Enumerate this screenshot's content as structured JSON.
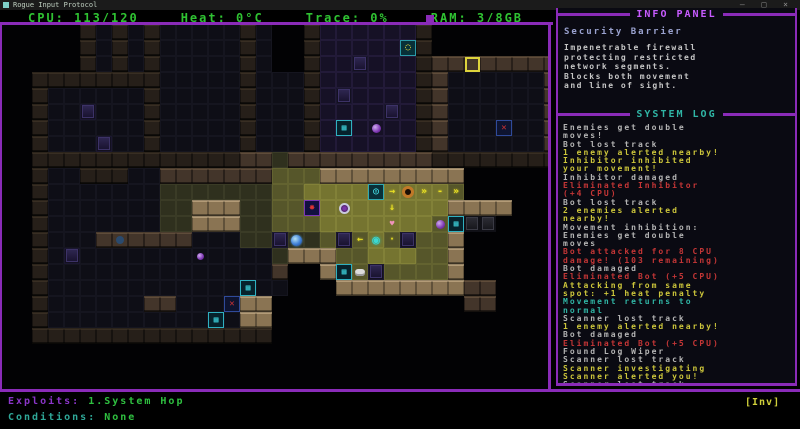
{
  "window": {
    "title": "Rogue Input Protocol",
    "controls": "– □ ×"
  },
  "colors": {
    "accent_purple": "#8a2bb8",
    "text_green": "#2fc232",
    "log_gray": "#b4b4b4",
    "log_yellow": "#cdc63b",
    "log_red": "#c53636",
    "log_cyan": "#30b5a5"
  },
  "stats": [
    {
      "label": "CPU:",
      "value": "113/120"
    },
    {
      "label": "Heat:",
      "value": "0°C"
    },
    {
      "label": "Trace:",
      "value": "0%"
    },
    {
      "label": "RAM:",
      "value": "3/8GB"
    }
  ],
  "map": {
    "tile_size": 16,
    "legend": {
      "#": "w-dark",
      "M": "w-mid",
      "W": "w-lit",
      ".": "f-dark",
      "p": "f-purple",
      "g": "f-dim",
      "y": "f-lit",
      "Y": "f-bright",
      "r": "rack",
      "G": "rack-gray"
    },
    "rows": [
      "     #.#.#.....#.  #pppppp#        ",
      "     #.#.#.....#.  #pppppp#        ",
      "     #.#.#.....#.  #pprppp#MMMMMMMM",
      "  ########.....#...#pppppp#M......M",
      "  #......#.....#...#prpppp#M......M",
      "  #..r...#.....#...#pppprp#M......M",
      "  #......#.....#...#pppppp#M......M",
      "  #...r..#.....#...#pppppp#M......M",
      "  #############MMgMMMMMMMMM########",
      "  #..###..MMMMMMMyyyWWWWWWWWW      ",
      "  #.......gggggggyyYYYYYYYYYy      ",
      "  #.......ggWWWggyyyYYYYYYYYWWWW   ",
      "  #.......ggWWWggyyyYYYYYYYyyGG    ",
      "  #...MMMMMM...ggrggyryYyryyW      ",
      "  #.r............gWWWyyYYYyyW      ",
      "  #..............M  WyyryyyyW      ",
      "  #...............   WWWWWWWWMM    ",
      "  #......MM....WW            MM    ",
      "  #............WW                  ",
      "  ###############                  ",
      "                                   ",
      "                                   ",
      "                                   "
    ],
    "entities": [
      {
        "name": "terminal-node",
        "col": 25,
        "row": 1,
        "cls": "ytc",
        "glyph": "◌"
      },
      {
        "name": "target-cursor",
        "col": 29,
        "row": 2,
        "cls": "cursor",
        "glyph": ""
      },
      {
        "name": "hazard-marker",
        "col": 31,
        "row": 6,
        "cls": "redx",
        "glyph": "✕"
      },
      {
        "name": "data-cache",
        "col": 21,
        "row": 6,
        "cls": "box",
        "glyph": "▦"
      },
      {
        "name": "signal-orb",
        "col": 23,
        "row": 6,
        "cls": "orb-purple",
        "glyph": ""
      },
      {
        "name": "scanner-bot",
        "col": 23,
        "row": 10,
        "cls": "scanner",
        "glyph": "◎"
      },
      {
        "name": "beam-segment",
        "col": 24,
        "row": 10,
        "cls": "beam",
        "glyph": "→"
      },
      {
        "name": "patrol-bot",
        "col": 25,
        "row": 10,
        "cls": "orange",
        "glyph": ""
      },
      {
        "name": "beam-segment",
        "col": 26,
        "row": 10,
        "cls": "beam",
        "glyph": "»"
      },
      {
        "name": "beam-segment",
        "col": 27,
        "row": 10,
        "cls": "beam",
        "glyph": "-"
      },
      {
        "name": "beam-segment",
        "col": 28,
        "row": 10,
        "cls": "beam",
        "glyph": "»"
      },
      {
        "name": "alert-marker",
        "col": 19,
        "row": 11,
        "cls": "star",
        "glyph": "✸"
      },
      {
        "name": "watcher-bot",
        "col": 21,
        "row": 11,
        "cls": "eye",
        "glyph": ""
      },
      {
        "name": "beam-segment",
        "col": 24,
        "row": 11,
        "cls": "beam",
        "glyph": "↓"
      },
      {
        "name": "pink-item",
        "col": 24,
        "row": 12,
        "cls": "pink",
        "glyph": "♥"
      },
      {
        "name": "signal-orb",
        "col": 27,
        "row": 12,
        "cls": "orb-purple",
        "glyph": ""
      },
      {
        "name": "data-cache",
        "col": 28,
        "row": 12,
        "cls": "box",
        "glyph": "▦"
      },
      {
        "name": "bot-enemy",
        "col": 18,
        "row": 13,
        "cls": "orb-blue",
        "glyph": ""
      },
      {
        "name": "beam-segment",
        "col": 22,
        "row": 13,
        "cls": "beam",
        "glyph": "←"
      },
      {
        "name": "player-avatar",
        "col": 23,
        "row": 13,
        "cls": "player",
        "glyph": "◉"
      },
      {
        "name": "beam-segment",
        "col": 24,
        "row": 13,
        "cls": "beam",
        "glyph": "·"
      },
      {
        "name": "data-cache",
        "col": 21,
        "row": 15,
        "cls": "box",
        "glyph": "▦"
      },
      {
        "name": "log-wiper-item",
        "col": 22,
        "row": 15,
        "cls": "white",
        "glyph": ""
      },
      {
        "name": "signal-orb",
        "col": 12,
        "row": 14,
        "cls": "orb-purple-sm",
        "glyph": ""
      },
      {
        "name": "hazard-marker",
        "col": 14,
        "row": 17,
        "cls": "redx",
        "glyph": "✕"
      },
      {
        "name": "data-cache",
        "col": 15,
        "row": 16,
        "cls": "box",
        "glyph": "▦"
      },
      {
        "name": "data-cache",
        "col": 13,
        "row": 18,
        "cls": "box",
        "glyph": "▦"
      },
      {
        "name": "bot-tracked",
        "col": 7,
        "row": 13,
        "cls": "orb-dimblue",
        "glyph": ""
      }
    ]
  },
  "info_panel": {
    "title": "INFO PANEL",
    "heading": "Security Barrier",
    "body": [
      "Impenetrable firewall",
      "protecting restricted",
      "network segments.",
      "Blocks both movement",
      "and line of sight."
    ]
  },
  "system_log": {
    "title": "SYSTEM LOG",
    "lines": [
      {
        "t": "Enemies get double",
        "c": "gray"
      },
      {
        "t": "moves!",
        "c": "gray"
      },
      {
        "t": "Bot lost track",
        "c": "gray"
      },
      {
        "t": "1 enemy alerted nearby!",
        "c": "yellow"
      },
      {
        "t": "Inhibitor inhibited",
        "c": "yellow"
      },
      {
        "t": "your movement!",
        "c": "yellow"
      },
      {
        "t": "Inhibitor damaged",
        "c": "gray"
      },
      {
        "t": "Eliminated Inhibitor",
        "c": "red"
      },
      {
        "t": "(+4 CPU)",
        "c": "red"
      },
      {
        "t": "Bot lost track",
        "c": "gray"
      },
      {
        "t": "2 enemies alerted",
        "c": "yellow"
      },
      {
        "t": "nearby!",
        "c": "yellow"
      },
      {
        "t": "Movement inhibition:",
        "c": "gray"
      },
      {
        "t": "Enemies get double",
        "c": "gray"
      },
      {
        "t": "moves",
        "c": "gray"
      },
      {
        "t": "Bot attacked for 8 CPU",
        "c": "red"
      },
      {
        "t": "damage! (103 remaining)",
        "c": "red"
      },
      {
        "t": "Bot damaged",
        "c": "gray"
      },
      {
        "t": "Eliminated Bot (+5 CPU)",
        "c": "red"
      },
      {
        "t": "Attacking from same",
        "c": "yellow"
      },
      {
        "t": "spot: +1 heat penalty",
        "c": "yellow"
      },
      {
        "t": "Movement returns to",
        "c": "cyan"
      },
      {
        "t": "normal",
        "c": "cyan"
      },
      {
        "t": "Scanner lost track",
        "c": "gray"
      },
      {
        "t": "1 enemy alerted nearby!",
        "c": "yellow"
      },
      {
        "t": "Bot damaged",
        "c": "gray"
      },
      {
        "t": "Eliminated Bot (+5 CPU)",
        "c": "red"
      },
      {
        "t": "Found Log Wiper",
        "c": "gray"
      },
      {
        "t": "Scanner lost track",
        "c": "gray"
      },
      {
        "t": "Scanner investigating",
        "c": "yellow"
      },
      {
        "t": "Scanner alerted you!",
        "c": "yellow"
      },
      {
        "t": "Scanner lost track",
        "c": "gray"
      }
    ]
  },
  "status": {
    "exploits_label": "Exploits: ",
    "exploits_value": "1.System Hop",
    "conditions_label": "Conditions: ",
    "conditions_value": "None",
    "inv": "[Inv]"
  }
}
